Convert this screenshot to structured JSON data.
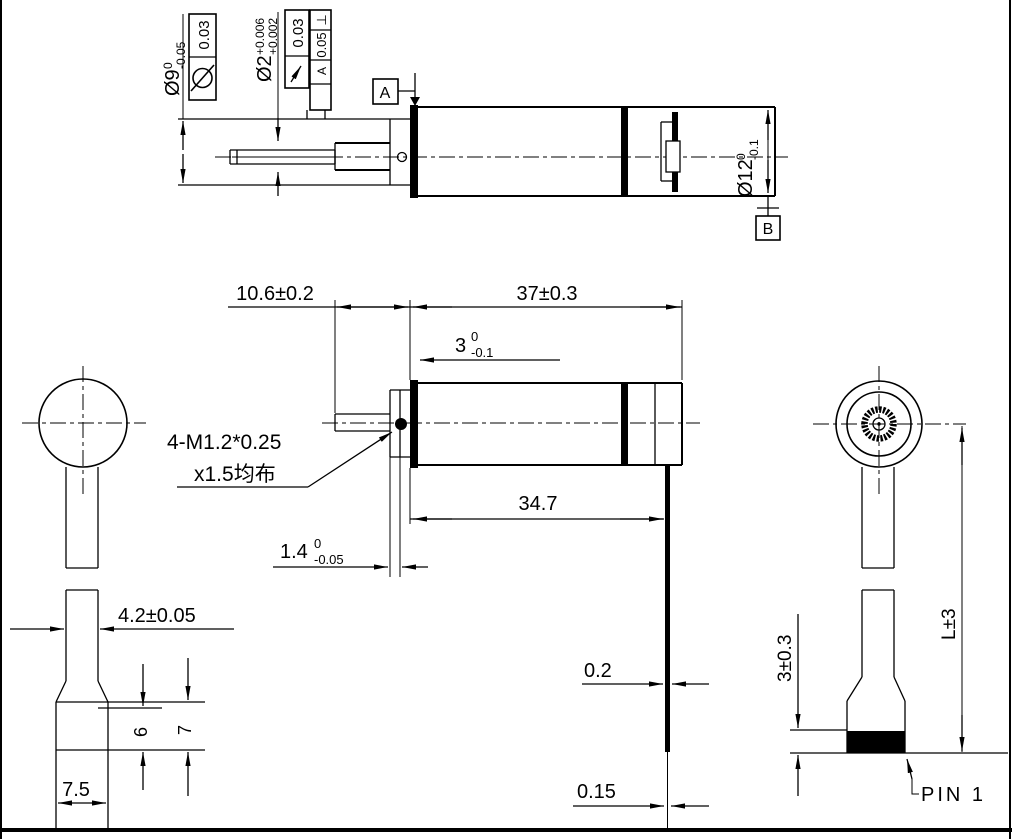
{
  "colors": {
    "ink": "#000000",
    "paper": "#ffffff"
  },
  "callouts": {
    "phi9": {
      "v": "Ø9",
      "up": "0",
      "lo": "-0.05"
    },
    "phi2": {
      "v": "Ø2",
      "up": "+0.006",
      "lo": "+0.002"
    },
    "phi12": {
      "v": "Ø12",
      "up": "0",
      "lo": "-0.1"
    },
    "face": {
      "v": "3",
      "up": "0",
      "lo": "-0.1"
    },
    "flange": {
      "v": "1.4",
      "up": "0",
      "lo": "-0.05"
    },
    "boss_len": "10.6±0.2",
    "body_len": "37±0.3",
    "gear_len": "34.7",
    "screw1": "4-M1.2*0.25",
    "screw2": "x1.5均布",
    "strip_w": "4.2±0.05",
    "conn_w": "7.5",
    "conn_h_inner": "6",
    "conn_h_outer": "7",
    "fpc_thickness": "0.2",
    "fpc_thickness2": "0.15",
    "conn_h": "3±0.3",
    "total_len": "L±3",
    "pin_label": "PIN 1"
  },
  "datums": {
    "a": "A",
    "b": "B"
  },
  "fcf": {
    "frame1": {
      "symbol": "concentricity",
      "value": "0.03"
    },
    "frame2": {
      "symbol": "circular-runout",
      "value": "0.03"
    },
    "frame3": {
      "symbol": "⊥",
      "value": "0.05",
      "datum": "A"
    }
  }
}
